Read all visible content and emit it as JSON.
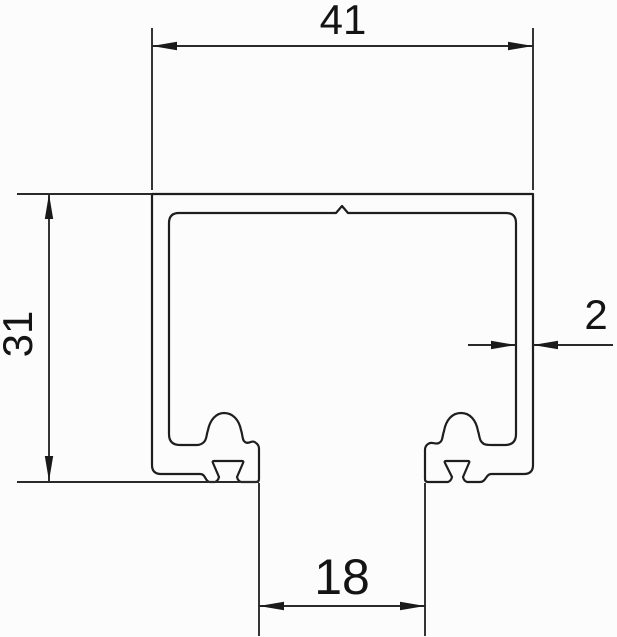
{
  "drawing": {
    "kind": "technical cross-section line drawing",
    "subject": "c-channel-track-profile",
    "units": "mm",
    "background_color": "#fcfcfc",
    "line_color": "#1e1e1e",
    "text_color": "#141414"
  },
  "dimensions": {
    "overall_width": {
      "label": "41",
      "value": 41
    },
    "overall_height": {
      "label": "31",
      "value": 31
    },
    "wall_thickness": {
      "label": "2",
      "value": 2
    },
    "bottom_opening": {
      "label": "18",
      "value": 18
    }
  }
}
